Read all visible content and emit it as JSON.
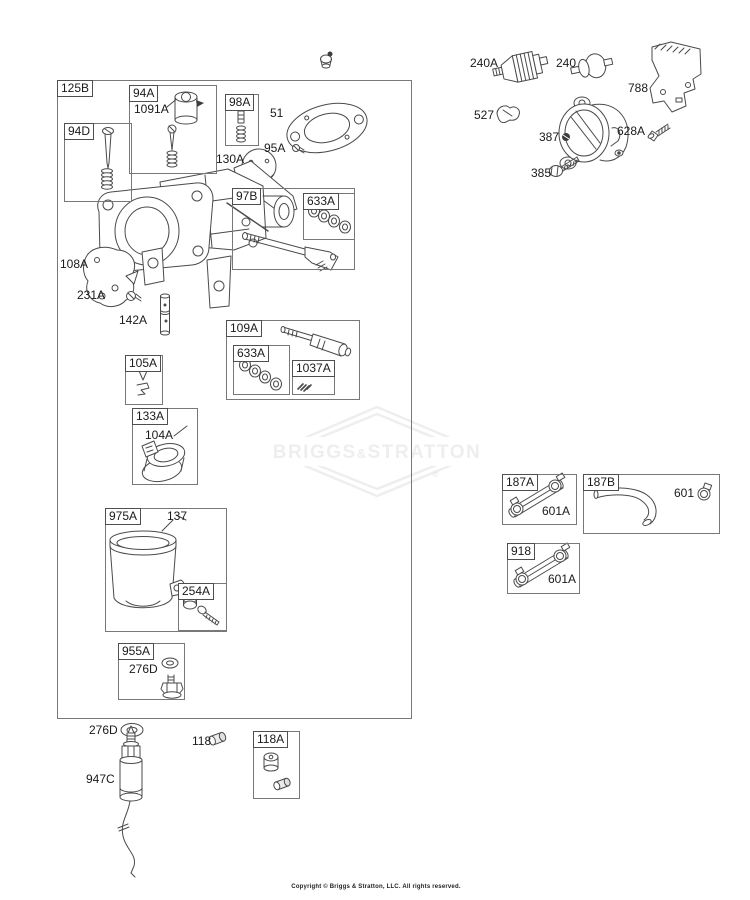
{
  "canvas": {
    "background": "#ffffff",
    "line_color": "#4a4a4a"
  },
  "watermark": {
    "left": "BRIGGS",
    "amp": "&",
    "right": "STRATTON",
    "registered": "®",
    "color": "#eeeeee"
  },
  "footer": {
    "copyright": "Copyright © Briggs & Stratton, LLC. All rights reserved."
  },
  "callouts": {
    "b125B": "125B",
    "b94A": "94A",
    "n1091A": "1091A",
    "b94D": "94D",
    "b98A": "98A",
    "n51": "51",
    "n95A": "95A",
    "n130A": "130A",
    "b97B": "97B",
    "b633Aa": "633A",
    "n108A": "108A",
    "n231A": "231A",
    "n142A": "142A",
    "b109A": "109A",
    "b633Ab": "633A",
    "b1037A": "1037A",
    "b105A": "105A",
    "b133A": "133A",
    "n104A": "104A",
    "b975A": "975A",
    "n137": "137",
    "b254A": "254A",
    "b955A": "955A",
    "n276Da": "276D",
    "n276Db": "276D",
    "n947C": "947C",
    "n118": "118",
    "b118A": "118A",
    "n240A": "240A",
    "n240": "240",
    "n788": "788",
    "n527": "527",
    "n387": "387",
    "n628A": "628A",
    "n385": "385",
    "b187A": "187A",
    "n601Aa": "601A",
    "b187B": "187B",
    "n601": "601",
    "b918": "918",
    "n601Ab": "601A"
  }
}
